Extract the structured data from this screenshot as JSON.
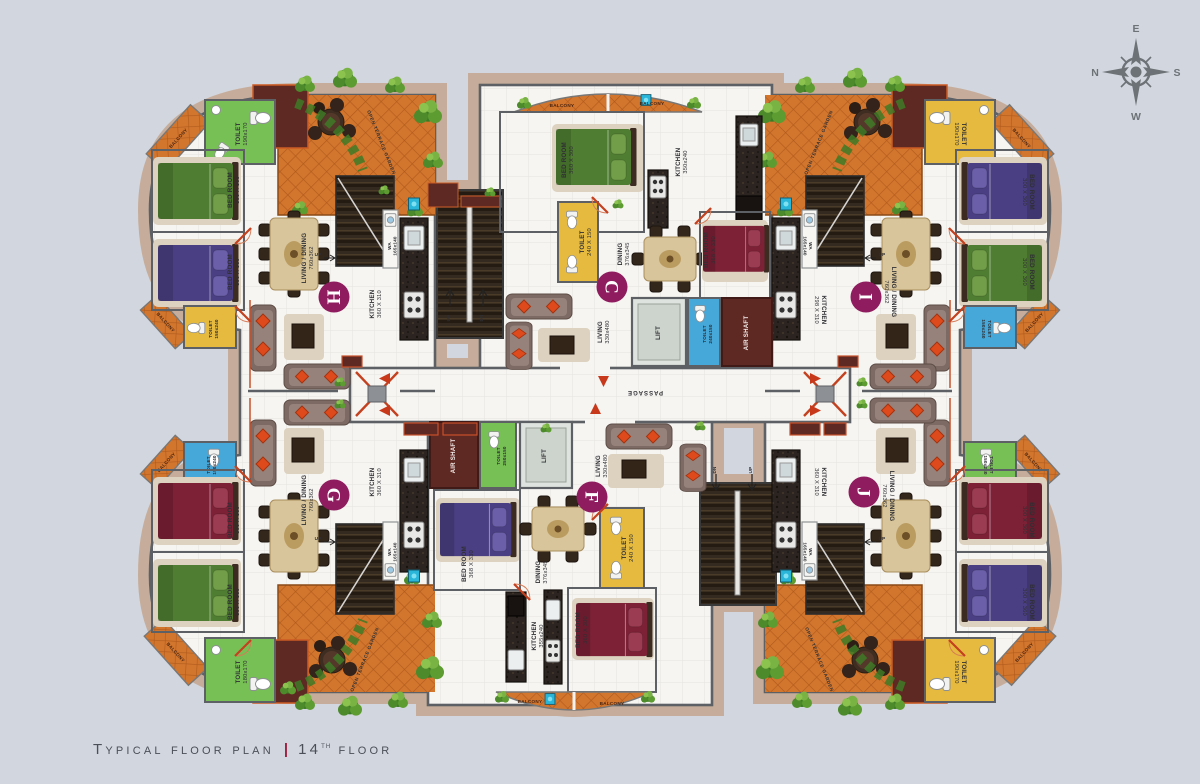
{
  "title": {
    "main": "Typical floor plan",
    "separator": "|",
    "floor_number": "14",
    "floor_ordinal": "th",
    "floor_word": "floor"
  },
  "compass": {
    "north": "N",
    "east": "E",
    "south": "S",
    "west": "W"
  },
  "passage": {
    "label": "PASSAGE"
  },
  "stairs": {
    "up": "UP",
    "dn": "DN"
  },
  "core_top": {
    "lift": "LIFT",
    "toilet": "TOILET",
    "toilet_dim": "240x150",
    "air_shaft": "AIR SHAFT"
  },
  "core_bottom": {
    "lift": "LIFT",
    "toilet": "TOILET",
    "toilet_dim": "250x150",
    "air_shaft": "AIR SHAFT"
  },
  "colors": {
    "background": "#d2d6de",
    "unit_badge": "#8e1c5e",
    "terrace_tile": "#d2762e",
    "title_separator": "#9e2140"
  },
  "units": {
    "h": {
      "id": "H",
      "toilet_top": {
        "label": "TOILET",
        "dim": "190x170"
      },
      "balcony_top": {
        "label": "BALCONY"
      },
      "terrace": {
        "label": "OPEN TERRACE GARDEN"
      },
      "bedroom1": {
        "label": "BED ROOM",
        "dim": "300 X 360"
      },
      "bedroom2": {
        "label": "BED ROOM",
        "dim": "300 X 360"
      },
      "toilet_bottom": {
        "label": "TOILET",
        "dim": "150x240"
      },
      "balcony_bottom": {
        "label": "BALCONY"
      },
      "living": {
        "label": "LIVING / DINING",
        "dim": "760x362"
      },
      "kitchen": {
        "label": "KITCHEN",
        "dim": "360 X 310"
      },
      "wa": {
        "label": "WA",
        "dim": "165x140"
      }
    },
    "i": {
      "id": "I",
      "toilet_top": {
        "label": "TOILET",
        "dim": "190x170"
      },
      "balcony_top": {
        "label": "BALCONY"
      },
      "terrace": {
        "label": "OPEN TERRACE GARDEN"
      },
      "bedroom1": {
        "label": "BED ROOM",
        "dim": "300 X 360"
      },
      "bedroom2": {
        "label": "BED ROOM",
        "dim": "300 X 360"
      },
      "toilet_bottom": {
        "label": "TOILET",
        "dim": "150x240"
      },
      "balcony_bottom": {
        "label": "BALCONY"
      },
      "living": {
        "label": "LIVING / DINING",
        "dim": "760x362"
      },
      "kitchen": {
        "label": "KITCHEN",
        "dim": "298 X 310"
      },
      "wa": {
        "label": "WA",
        "dim": "165x140"
      }
    },
    "g": {
      "id": "G",
      "toilet_top": {
        "label": "TOILET",
        "dim": "150x240"
      },
      "balcony_top": {
        "label": "BALCONY"
      },
      "terrace": {
        "label": "OPEN TERRACE GARDEN"
      },
      "bedroom1": {
        "label": "BED ROOM",
        "dim": "300 X 360"
      },
      "bedroom2": {
        "label": "BED ROOM",
        "dim": "300 X 360"
      },
      "toilet_bottom": {
        "label": "TOILET",
        "dim": "180x170"
      },
      "balcony_bottom": {
        "label": "BALCONY"
      },
      "living": {
        "label": "LIVING / DINING",
        "dim": "760x362"
      },
      "kitchen": {
        "label": "KITCHEN",
        "dim": "360 X 310"
      },
      "wa": {
        "label": "WA",
        "dim": "165x140"
      }
    },
    "j": {
      "id": "J",
      "toilet_top": {
        "label": "TOILET",
        "dim": "150x240"
      },
      "balcony_top": {
        "label": "BALCONY"
      },
      "terrace": {
        "label": "OPEN TERRACE GARDEN"
      },
      "bedroom1": {
        "label": "BED ROOM",
        "dim": "300 X 360"
      },
      "bedroom2": {
        "label": "BED ROOM",
        "dim": "300 X 360"
      },
      "toilet_bottom": {
        "label": "TOILET",
        "dim": "190x170"
      },
      "balcony_bottom": {
        "label": "BALCONY"
      },
      "living": {
        "label": "LIVING / DINING",
        "dim": "760x362"
      },
      "kitchen": {
        "label": "KITCHEN",
        "dim": "360 X 310"
      },
      "wa": {
        "label": "WA",
        "dim": "165x140"
      }
    },
    "c": {
      "id": "C",
      "balcony1": {
        "label": "BALCONY"
      },
      "balcony2": {
        "label": "BALCONY"
      },
      "bedroom1": {
        "label": "BED ROOM",
        "dim": "360 X 300"
      },
      "kitchen": {
        "label": "KITCHEN",
        "dim": "350x240"
      },
      "toilet": {
        "label": "TOILET",
        "dim": "240 X 150"
      },
      "dining": {
        "label": "DINING",
        "dim": "376x345"
      },
      "bedroom2": {
        "label": "BED ROOM",
        "dim": "368 X 330"
      },
      "living": {
        "label": "LIVING",
        "dim": "330x480"
      }
    },
    "f": {
      "id": "F",
      "living": {
        "label": "LIVING",
        "dim": "330x480"
      },
      "bedroom1": {
        "label": "BED ROOM",
        "dim": "368 X 330"
      },
      "dining": {
        "label": "DINING",
        "dim": "376x345"
      },
      "toilet": {
        "label": "TOILET",
        "dim": "240 X 150"
      },
      "kitchen": {
        "label": "KITCHEN",
        "dim": "355x240"
      },
      "bedroom2": {
        "label": "BED ROOM",
        "dim": "360 X 300"
      },
      "balcony1": {
        "label": "BALCONY"
      },
      "balcony2": {
        "label": "BALCONY"
      }
    }
  }
}
